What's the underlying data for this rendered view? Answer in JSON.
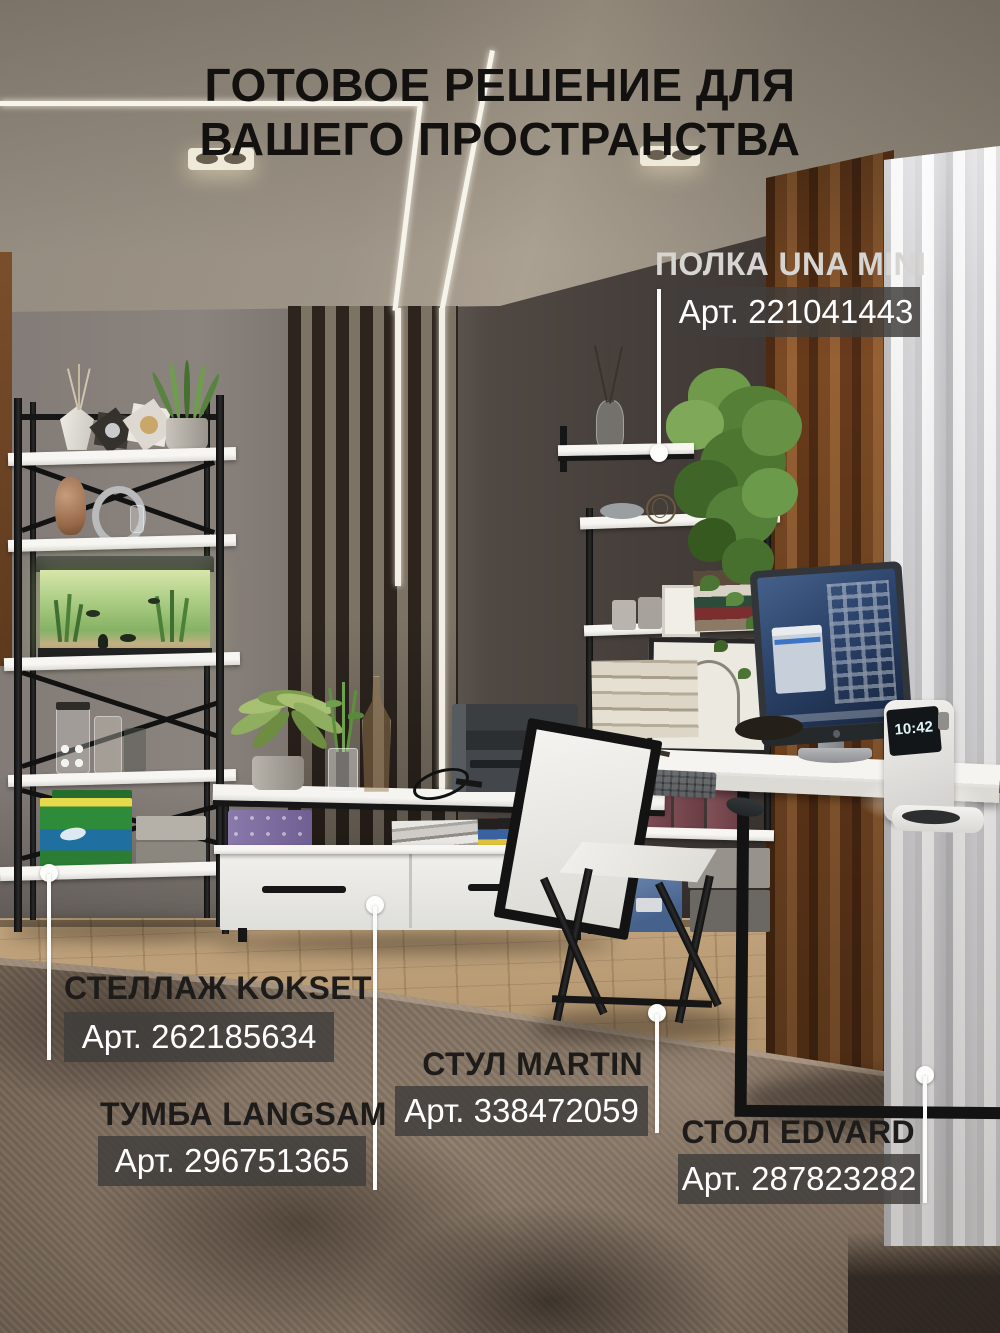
{
  "title": {
    "line1": "ГОТОВОЕ РЕШЕНИЕ ДЛЯ",
    "line2": "ВАШЕГО ПРОСТРАНСТВА"
  },
  "products": [
    {
      "name": "ПОЛКА UNA MINI",
      "article": "Арт. 221041443"
    },
    {
      "name": "СТЕЛЛАЖ KOKSET",
      "article": "Арт. 262185634"
    },
    {
      "name": "ТУМБА LANGSAM",
      "article": "Арт. 296751365"
    },
    {
      "name": "СТУЛ MARTIN",
      "article": "Арт. 338472059"
    },
    {
      "name": "СТОЛ EDVARD",
      "article": "Арт. 287823282"
    }
  ],
  "scene": {
    "clock_time": "10:42"
  },
  "colors": {
    "badge_background": "rgba(64,62,60,0.84)",
    "leader_line": "#ffffff",
    "title_text": "#121110"
  }
}
